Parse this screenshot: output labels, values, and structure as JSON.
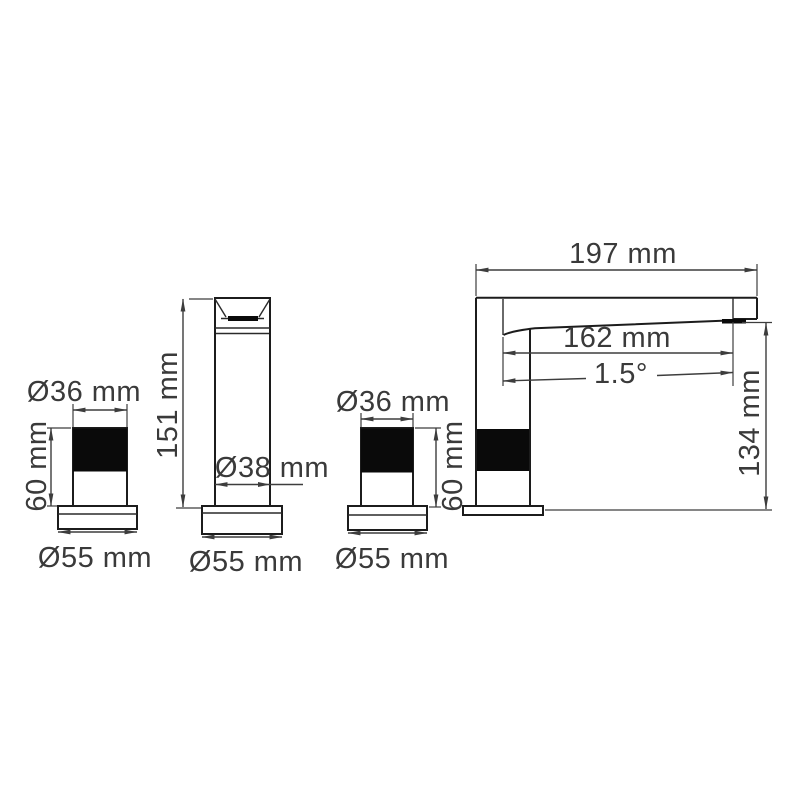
{
  "drawing": {
    "kind": "faucet technical dimension drawing",
    "unit": "mm",
    "background": "#ffffff",
    "line_color": "#1c1c1c",
    "text_color": "#3a3a3a"
  },
  "labels": {
    "total_length": "197 mm",
    "spout_reach": "162 mm",
    "spout_angle": "1.5°",
    "overall_height": "134 mm",
    "column_height": "151 mm",
    "column_diameter": "Ø38 mm",
    "column_base_diameter": "Ø55 mm",
    "left_handle_diameter": "Ø36 mm",
    "left_handle_height": "60 mm",
    "left_handle_base_diameter": "Ø55 mm",
    "right_handle_diameter": "Ø36 mm",
    "right_handle_height": "60 mm",
    "right_handle_base_diameter": "Ø55 mm"
  },
  "views": [
    {
      "name": "left-handle-front",
      "dimensions": [
        "Ø36 mm",
        "60 mm",
        "Ø55 mm"
      ]
    },
    {
      "name": "spout-column-front",
      "dimensions": [
        "151 mm",
        "Ø38 mm",
        "Ø55 mm"
      ]
    },
    {
      "name": "right-handle-front",
      "dimensions": [
        "Ø36 mm",
        "60 mm",
        "Ø55 mm"
      ]
    },
    {
      "name": "faucet-side",
      "dimensions": [
        "197 mm",
        "162 mm",
        "1.5°",
        "134 mm"
      ]
    }
  ]
}
